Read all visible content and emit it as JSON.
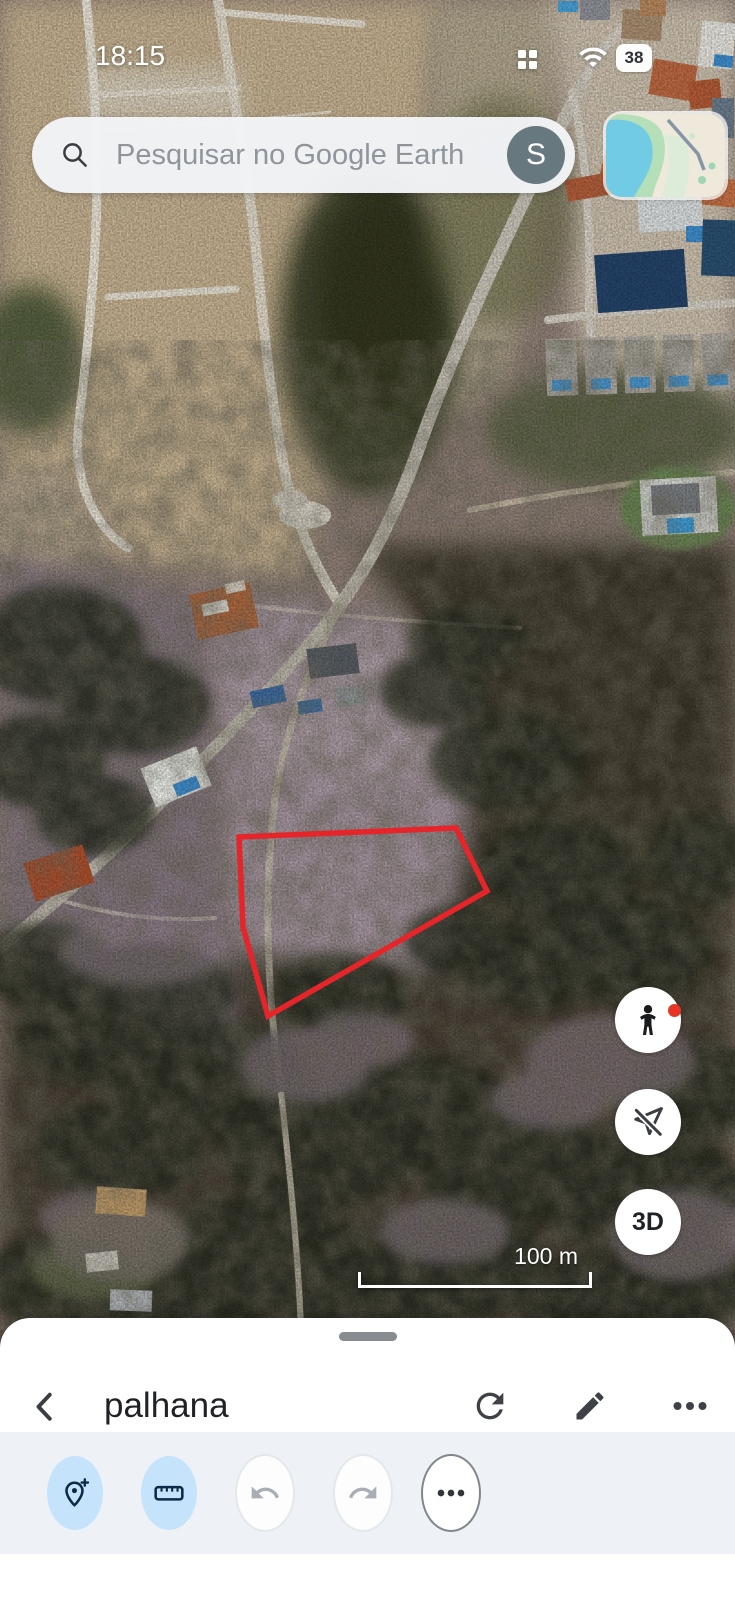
{
  "status_bar": {
    "time": "18:15",
    "battery_percent": "38"
  },
  "search_bar": {
    "placeholder": "Pesquisar no Google Earth",
    "account_initial": "S"
  },
  "map_view": {
    "scale_label": "100 m",
    "three_d_label": "3D"
  },
  "bottom_sheet": {
    "title": "palhana"
  },
  "colors": {
    "parcel_outline": "#e5252a",
    "toolbar_active_bg": "#c5e3fb",
    "toolbar_active_icon": "#0d2b47",
    "avatar_bg": "#67787f",
    "toolbar_bg": "#eef2f7",
    "sheet_bg": "#ffffff"
  }
}
